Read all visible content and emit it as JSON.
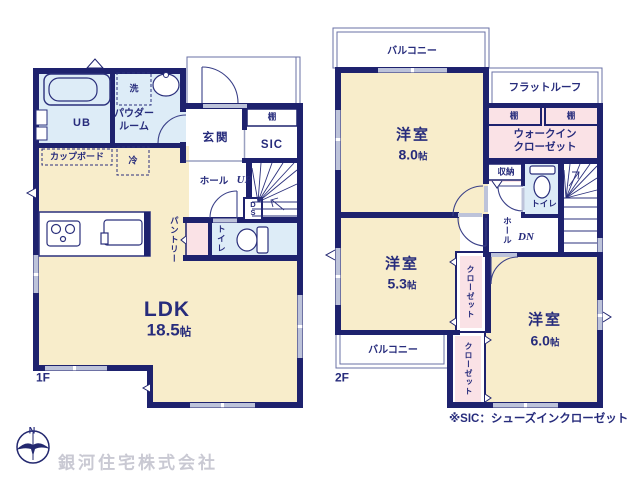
{
  "colors": {
    "wall_navy": "#1e226e",
    "text_navy": "#272c7c",
    "room_cream": "#f8edcb",
    "wet_area_blue": "#ddecf7",
    "closet_pink": "#fae2e6",
    "window_gray": "#bdc3da",
    "watermark_gray": "#c9c9d3"
  },
  "floor1": {
    "label": "1F",
    "ldk": {
      "name": "LDK",
      "size": "18.5",
      "unit": "帖"
    },
    "unit_bath": "UB",
    "laundry": "洗",
    "powder_room": "パウダールーム",
    "cupboard": "カップボード",
    "fridge": "冷",
    "entrance": "玄関",
    "sic": "SIC",
    "shelf": "棚",
    "hall": "ホール",
    "stairs_up": "UP",
    "duct_space": "DS",
    "toilet": "トイレ",
    "pantry": "パントリー"
  },
  "floor2": {
    "label": "2F",
    "balcony_top": "バルコニー",
    "balcony_bottom": "バルコニー",
    "flat_roof": "フラットルーフ",
    "room_8": {
      "name": "洋室",
      "size": "8.0",
      "unit": "帖"
    },
    "room_53": {
      "name": "洋室",
      "size": "5.3",
      "unit": "帖"
    },
    "room_6": {
      "name": "洋室",
      "size": "6.0",
      "unit": "帖"
    },
    "walk_in_closet": "ウォークインクローゼット",
    "shelf_left": "棚",
    "shelf_right": "棚",
    "storage": "収納",
    "toilet": "トイレ",
    "hall": "ホール",
    "stairs_down": "DN",
    "closet_53": "クローゼット",
    "closet_6": "クローゼット"
  },
  "footer": {
    "note": "※SIC：シューズインクローゼット",
    "company": "銀河住宅株式会社",
    "compass_north": "N"
  }
}
